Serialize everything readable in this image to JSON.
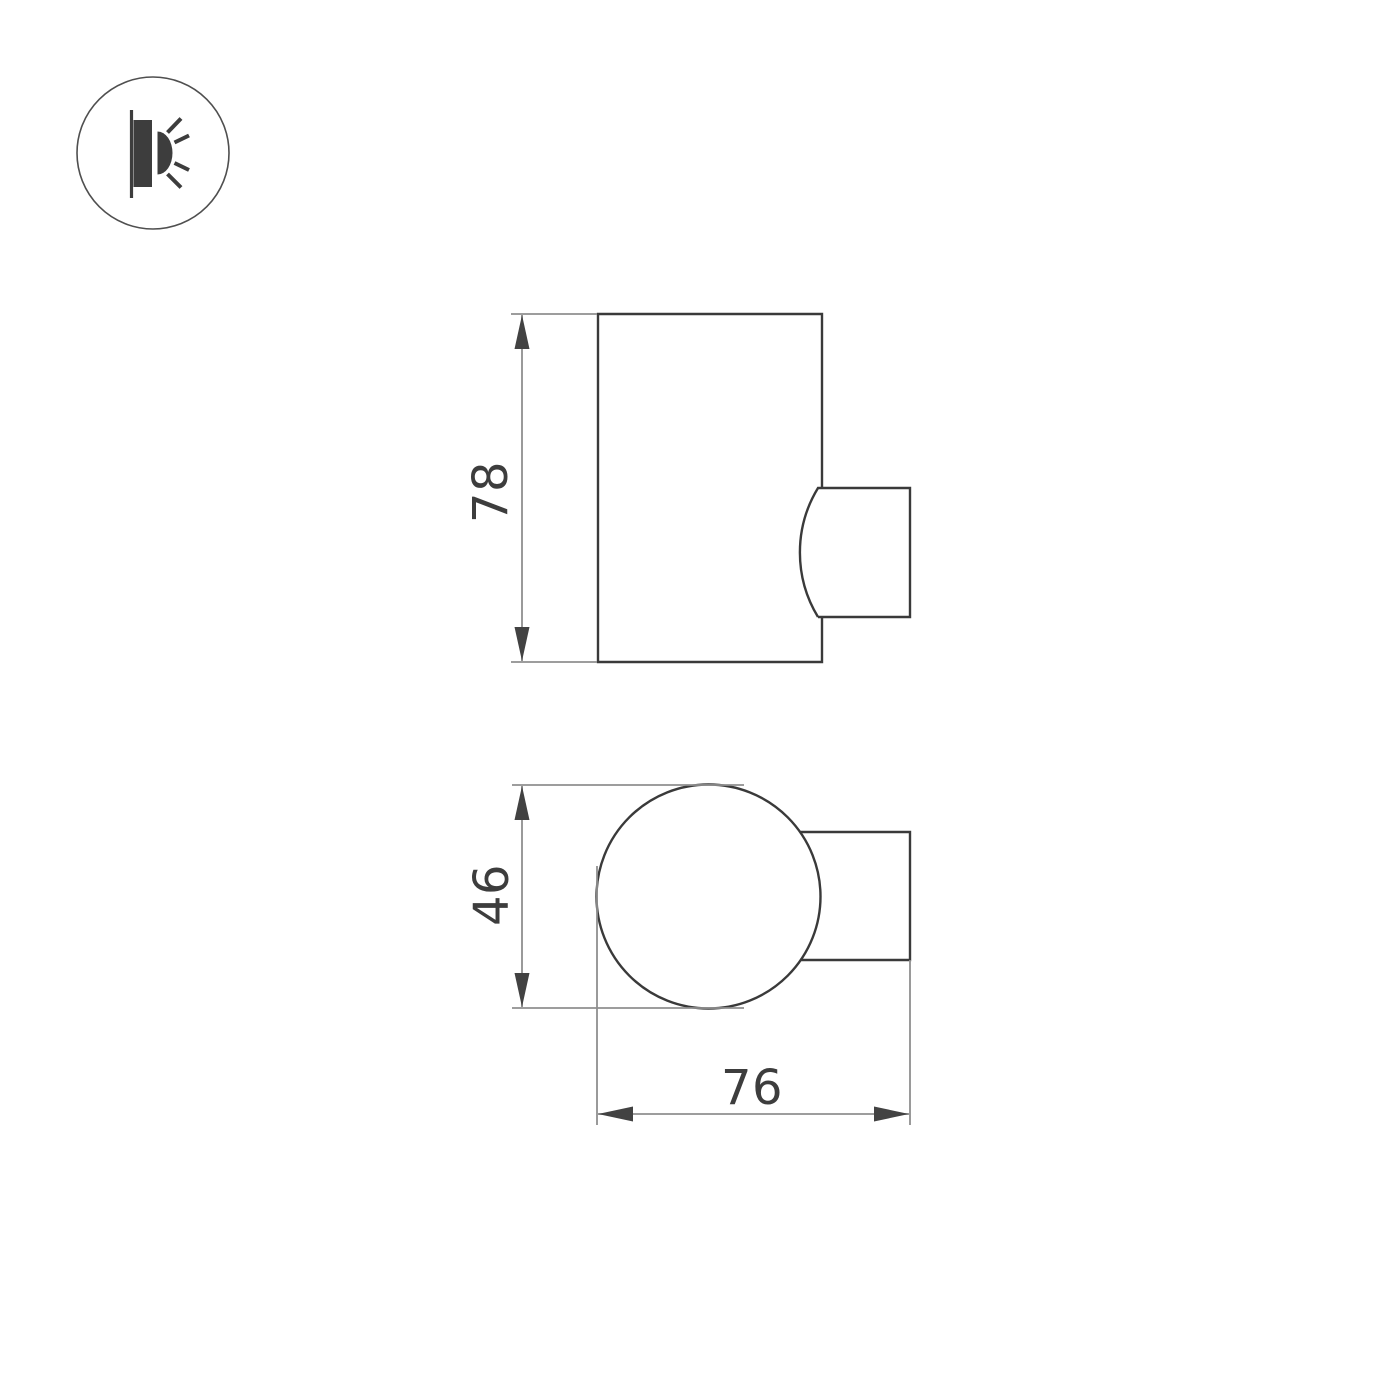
{
  "colors": {
    "background": "#ffffff",
    "part_outline": "#3a3a3a",
    "dimension_lines": "#8f8f8f",
    "dimension_text": "#3d3d3d",
    "icon": "#3d3d3d"
  },
  "badge": {
    "icon": "wall-lamp-emitting-light-icon"
  },
  "views": {
    "side": {
      "height": {
        "label": "78"
      }
    },
    "top": {
      "diameter": {
        "label": "46"
      },
      "width": {
        "label": "76"
      }
    }
  }
}
